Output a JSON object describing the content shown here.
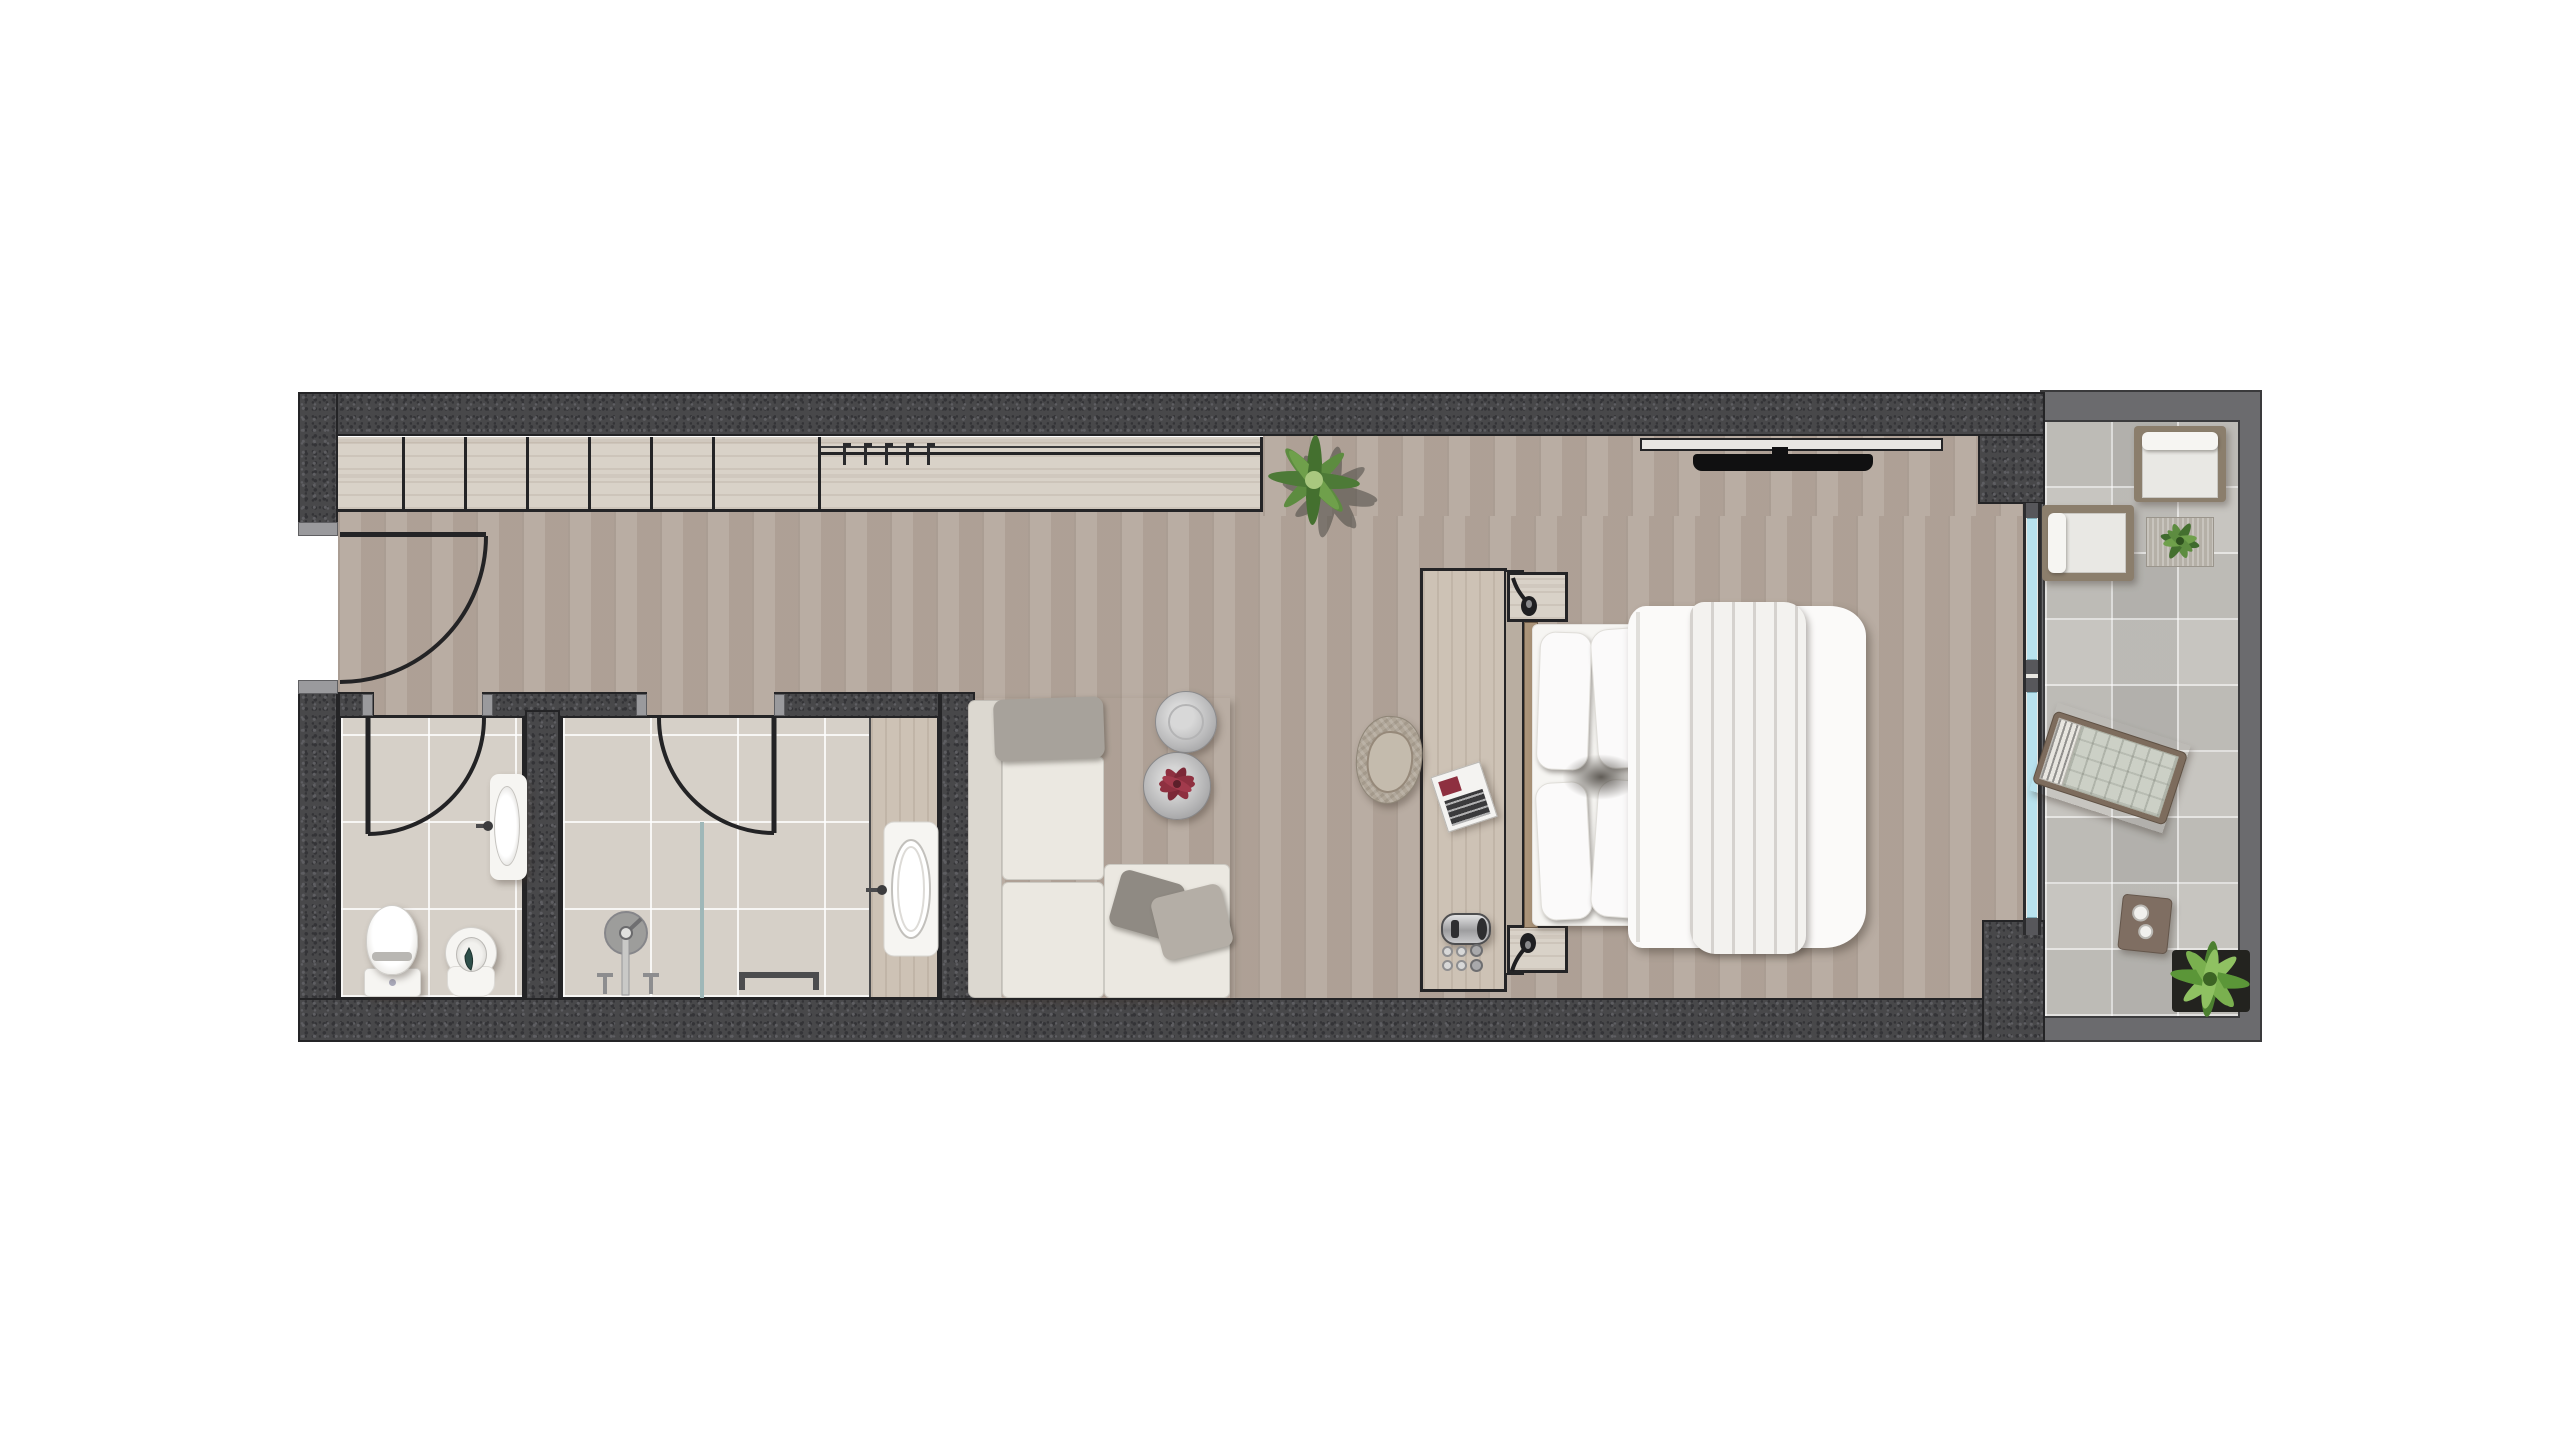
{
  "title": "Studio suite floor plan — top-down architectural render (no text labels in image)",
  "canvas": {
    "width": 2560,
    "height": 1440,
    "background": "#ffffff"
  },
  "colors": {
    "wall-dark": "#48484a",
    "speck-l": "#5e5e62",
    "speck-d": "#343437",
    "jamb": "#9a9a9d",
    "balcony-wall": "#6b6b6e",
    "outline": "#242426",
    "wood-floor": "#b5a89d",
    "wood-light": "#d9d2c8",
    "wood-desk": "#cdc2b5",
    "wood-vanity": "#d2c9bd",
    "tile-bath": "#d6d0c8",
    "tile-balcony": "#c7c5c0",
    "glass": "#b8e2ee",
    "frame-gray": "#57575b",
    "white-furn": "#f6f5f2",
    "cream": "#ebe8e1",
    "cream-dark": "#dcd8d0",
    "gray-pillow": "#a7a29b",
    "green-dark": "#4d7a37",
    "green-mid": "#6fa04b",
    "green-light": "#8fc162",
    "metal": "#c6c6c6",
    "flower": "#8e3040",
    "wood-out": "#8b7e6c",
    "wood-out-dark": "#7d6c5d"
  },
  "rooms": [
    {
      "id": "entry-hall",
      "name": "Entry hall / corridor",
      "features": [
        "entry door with swing arc",
        "built-in wardrobe row of 7 sections",
        "open hanging rail with 5 hangers"
      ]
    },
    {
      "id": "bathroom-wc",
      "name": "Bathroom 1 (WC)",
      "fixtures": [
        "inward swing door",
        "wall-mounted sink",
        "toilet",
        "bidet"
      ]
    },
    {
      "id": "bathroom-shower",
      "name": "Bathroom 2 (shower room)",
      "fixtures": [
        "inward swing door",
        "rain shower head with floor pipe",
        "glass shower screen",
        "two floor taps",
        "towel rail",
        "vanity counter with sink"
      ]
    },
    {
      "id": "living-area",
      "name": "Living area",
      "furniture": [
        "L-shaped cream sofa",
        "gray headrest pillow",
        "two gray throw pillows",
        "two round metal nesting tables",
        "flower decoration on table",
        "woven armchair",
        "floor plant"
      ]
    },
    {
      "id": "sleeping-area",
      "name": "Sleeping area",
      "furniture": [
        "double bed with 4 pillows",
        "white duvet",
        "knit throw blanket",
        "headboard partition wall",
        "top nightstand with sconce",
        "bottom nightstand with sconce",
        "console desk",
        "kettle",
        "six cups",
        "magazine",
        "wall-mounted TV with shelf bracket"
      ]
    },
    {
      "id": "balcony",
      "name": "Balcony / terrace",
      "furniture": [
        "outdoor armchair (top)",
        "outdoor armchair (left)",
        "outdoor rug with small plant",
        "sun lounger (diagonal)",
        "square side table with two cups",
        "large potted plant"
      ],
      "glazing": [
        "full-height sliding window separating bedroom and balcony"
      ]
    }
  ],
  "counts": {
    "wardrobe_sections": 7,
    "hangers": 5,
    "bed_pillows": 4,
    "cups_on_desk": 6,
    "balcony_armchairs": 2,
    "bathrooms": 2,
    "door_swing_arcs": 3
  }
}
